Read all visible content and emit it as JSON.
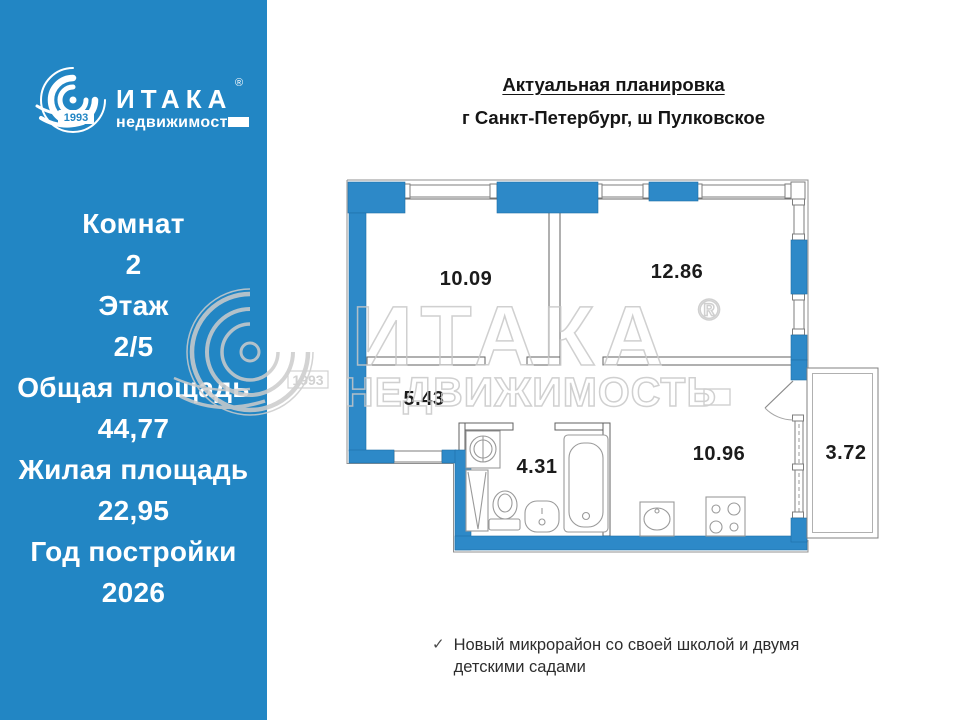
{
  "colors": {
    "brand_blue": "#2286c4",
    "wall_blue": "#2d89c8",
    "watermark_gray": "#c8c8c8"
  },
  "brand": {
    "name": "ИТАКА",
    "registered": "®",
    "subtitle": "недвижимость",
    "year_badge": "1993"
  },
  "sidebar": {
    "lines": [
      "Комнат",
      "2",
      "Этаж",
      "2/5",
      "Общая площадь",
      "44,77",
      "Жилая площадь",
      "22,95",
      "Год постройки",
      "2026"
    ]
  },
  "header": {
    "title": "Актуальная планировка",
    "address": "г Санкт-Петербург, ш Пулковское"
  },
  "floorplan": {
    "rooms": [
      {
        "area": "10.09"
      },
      {
        "area": "12.86"
      },
      {
        "area": "5.43"
      },
      {
        "area": "4.31"
      },
      {
        "area": "10.96"
      },
      {
        "area": "3.72"
      }
    ]
  },
  "watermark": {
    "brand": "ИТАКА",
    "subtitle": "НЕДВИЖИМОСТЬ",
    "year": "1993",
    "registered": "®"
  },
  "footnote": {
    "check": "✓",
    "text": "Новый микрорайон со своей школой и двумя детскими садами"
  }
}
